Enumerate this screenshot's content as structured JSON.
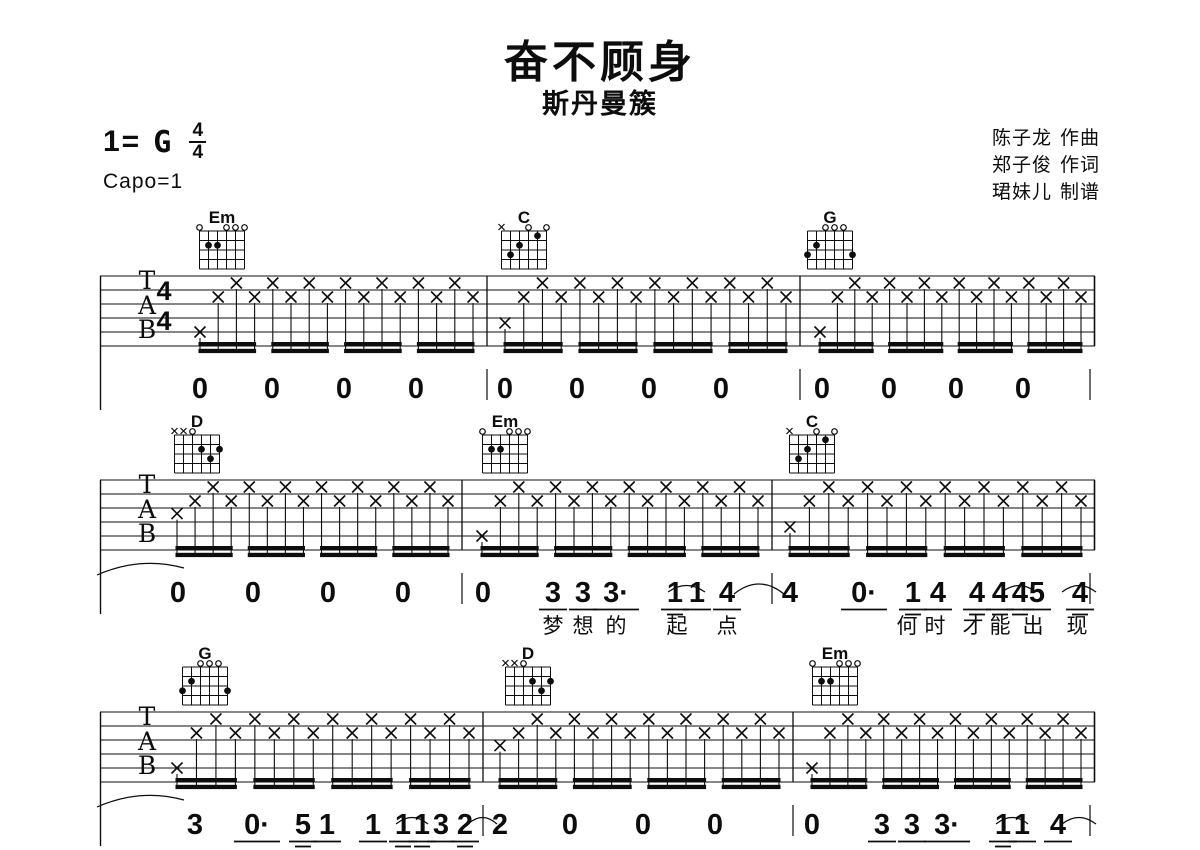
{
  "header": {
    "title": "奋不顾身",
    "artist": "斯丹曼簇",
    "key_prefix": "1=",
    "key_letter": "G",
    "meter_top": "4",
    "meter_bottom": "4",
    "capo_label": "Capo=1",
    "credits": [
      {
        "name": "陈子龙",
        "role": "作曲"
      },
      {
        "name": "郑子俊",
        "role": "作词"
      },
      {
        "name": "珺妹儿",
        "role": "制谱"
      }
    ]
  },
  "chord_shapes": {
    "Em": {
      "frets": [
        0,
        2,
        2,
        0,
        0,
        0
      ]
    },
    "C": {
      "frets": [
        -1,
        3,
        2,
        0,
        1,
        0
      ]
    },
    "G": {
      "frets": [
        3,
        2,
        0,
        0,
        0,
        3
      ]
    },
    "D": {
      "frets": [
        -1,
        -1,
        0,
        2,
        3,
        2
      ]
    }
  },
  "score": {
    "staff_left": 100,
    "staff_right": 1095,
    "tab_letters": [
      "T",
      "A",
      "B"
    ],
    "systems": [
      {
        "staff_top": 276,
        "show_meter": true,
        "chords": [
          {
            "name": "Em",
            "x": 222
          },
          {
            "name": "C",
            "x": 524
          },
          {
            "name": "G",
            "x": 830
          }
        ],
        "measures": [
          {
            "x0": 100,
            "x1": 487,
            "ns": 200,
            "bass": 4
          },
          {
            "x0": 487,
            "x1": 800,
            "ns": 505,
            "bass": 3.35
          },
          {
            "x0": 800,
            "x1": 1095,
            "ns": 820,
            "bass": 4
          }
        ],
        "numbers": [
          {
            "x": 200,
            "t": "0"
          },
          {
            "x": 272,
            "t": "0"
          },
          {
            "x": 344,
            "t": "0"
          },
          {
            "x": 416,
            "t": "0"
          },
          {
            "x": 505,
            "t": "0"
          },
          {
            "x": 577,
            "t": "0"
          },
          {
            "x": 649,
            "t": "0"
          },
          {
            "x": 721,
            "t": "0"
          },
          {
            "x": 822,
            "t": "0"
          },
          {
            "x": 889,
            "t": "0"
          },
          {
            "x": 956,
            "t": "0"
          },
          {
            "x": 1023,
            "t": "0"
          }
        ],
        "num_barlines": [
          487,
          800,
          1090
        ],
        "lyrics": [],
        "arcs": [],
        "left_arc": false
      },
      {
        "staff_top": 480,
        "show_meter": false,
        "chords": [
          {
            "name": "D",
            "x": 197
          },
          {
            "name": "Em",
            "x": 505
          },
          {
            "name": "C",
            "x": 812
          }
        ],
        "measures": [
          {
            "x0": 100,
            "x1": 462,
            "ns": 177,
            "bass": 2.4
          },
          {
            "x0": 462,
            "x1": 772,
            "ns": 482,
            "bass": 4
          },
          {
            "x0": 772,
            "x1": 1095,
            "ns": 790,
            "bass": 3.35
          }
        ],
        "numbers": [
          {
            "x": 178,
            "t": "0"
          },
          {
            "x": 253,
            "t": "0"
          },
          {
            "x": 328,
            "t": "0"
          },
          {
            "x": 403,
            "t": "0"
          },
          {
            "x": 483,
            "t": "0"
          },
          {
            "x": 553,
            "t": "3",
            "u": 1
          },
          {
            "x": 583,
            "t": "3",
            "u": 1
          },
          {
            "x": 616,
            "t": "3·",
            "u": 1
          },
          {
            "x": 675,
            "t": "1",
            "u": 2
          },
          {
            "x": 697,
            "t": "1",
            "u": 1
          },
          {
            "x": 727,
            "t": "4",
            "u": 1
          },
          {
            "x": 790,
            "t": "4"
          },
          {
            "x": 864,
            "t": "0·",
            "u": 1
          },
          {
            "x": 913,
            "t": "1",
            "u": 2
          },
          {
            "x": 938,
            "t": "4",
            "u": 1
          },
          {
            "x": 977,
            "t": "4",
            "u": 2
          },
          {
            "x": 1000,
            "t": "4",
            "u": 2
          },
          {
            "x": 1020,
            "t": "4",
            "u": 2
          },
          {
            "x": 1037,
            "t": "5",
            "u": 1
          },
          {
            "x": 1080,
            "t": "4",
            "u": 2
          }
        ],
        "num_barlines": [
          462,
          772,
          1090
        ],
        "lyrics": [
          {
            "x": 553,
            "t": "梦"
          },
          {
            "x": 583,
            "t": "想"
          },
          {
            "x": 616,
            "t": "的"
          },
          {
            "x": 677,
            "t": "起"
          },
          {
            "x": 727,
            "t": "点"
          },
          {
            "x": 907,
            "t": "何"
          },
          {
            "x": 935,
            "t": "时"
          },
          {
            "x": 973,
            "t": "才"
          },
          {
            "x": 1000,
            "t": "能"
          },
          {
            "x": 1033,
            "t": "出"
          },
          {
            "x": 1077,
            "t": "现"
          }
        ],
        "arcs": [
          [
            668,
            705
          ],
          [
            734,
            784
          ],
          [
            1002,
            1036
          ],
          [
            1062,
            1096
          ]
        ],
        "left_arc": true
      },
      {
        "staff_top": 712,
        "show_meter": false,
        "chords": [
          {
            "name": "G",
            "x": 205
          },
          {
            "name": "D",
            "x": 528
          },
          {
            "name": "Em",
            "x": 835
          }
        ],
        "measures": [
          {
            "x0": 100,
            "x1": 483,
            "ns": 177,
            "bass": 4
          },
          {
            "x0": 483,
            "x1": 793,
            "ns": 500,
            "bass": 2.4
          },
          {
            "x0": 793,
            "x1": 1095,
            "ns": 812,
            "bass": 4
          }
        ],
        "numbers": [
          {
            "x": 195,
            "t": "3"
          },
          {
            "x": 257,
            "t": "0·",
            "u": 1
          },
          {
            "x": 303,
            "t": "5",
            "u": 2,
            "low": true
          },
          {
            "x": 327,
            "t": "1",
            "u": 1
          },
          {
            "x": 373,
            "t": "1",
            "u": 1
          },
          {
            "x": 403,
            "t": "1",
            "u": 2
          },
          {
            "x": 422,
            "t": "1",
            "u": 2
          },
          {
            "x": 441,
            "t": "3",
            "u": 1
          },
          {
            "x": 465,
            "t": "2",
            "u": 2
          },
          {
            "x": 500,
            "t": "2"
          },
          {
            "x": 570,
            "t": "0"
          },
          {
            "x": 643,
            "t": "0"
          },
          {
            "x": 715,
            "t": "0"
          },
          {
            "x": 812,
            "t": "0"
          },
          {
            "x": 882,
            "t": "3",
            "u": 1
          },
          {
            "x": 912,
            "t": "3",
            "u": 1
          },
          {
            "x": 947,
            "t": "3·",
            "u": 1
          },
          {
            "x": 1003,
            "t": "1",
            "u": 2
          },
          {
            "x": 1022,
            "t": "1",
            "u": 1
          },
          {
            "x": 1058,
            "t": "4",
            "u": 1
          }
        ],
        "num_barlines": [
          483,
          793,
          1090
        ],
        "lyrics": [],
        "arcs": [
          [
            396,
            428
          ],
          [
            468,
            497
          ],
          [
            996,
            1028
          ],
          [
            1062,
            1096
          ]
        ],
        "left_arc": true
      }
    ]
  }
}
